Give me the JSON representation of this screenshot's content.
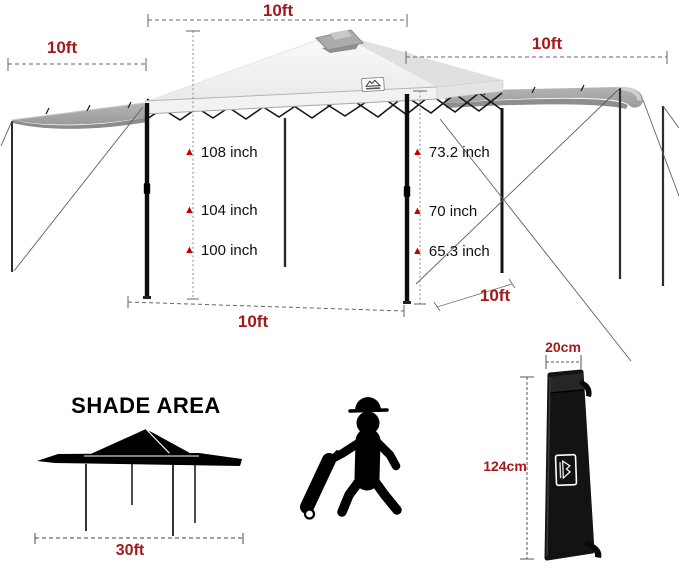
{
  "colors": {
    "dimension_red": "#A21A1D",
    "marker_red": "#C40000",
    "silhouette_black": "#000000",
    "canopy_gray": "#ECECEC",
    "awning_gray": "#A6A6A6"
  },
  "canopy_diagram": {
    "top_width_label": "10ft",
    "left_awning_width_label": "10ft",
    "right_awning_width_label": "10ft",
    "peak_heights": [
      "108 inch",
      "104 inch",
      "100 inch"
    ],
    "eave_heights": [
      "73.2 inch",
      "70 inch",
      "65.3 inch"
    ],
    "base_width_label": "10ft",
    "base_depth_label": "10ft"
  },
  "shade_area": {
    "title": "SHADE AREA",
    "width_label": "30ft"
  },
  "carry_bag": {
    "width_label": "20cm",
    "height_label": "124cm"
  },
  "icons": {
    "height_marker_glyph": "▲",
    "brand_logo": "mountain-logo",
    "bag_logo": "mountain-logo",
    "person": "person-pulling-wheeled-bag"
  }
}
